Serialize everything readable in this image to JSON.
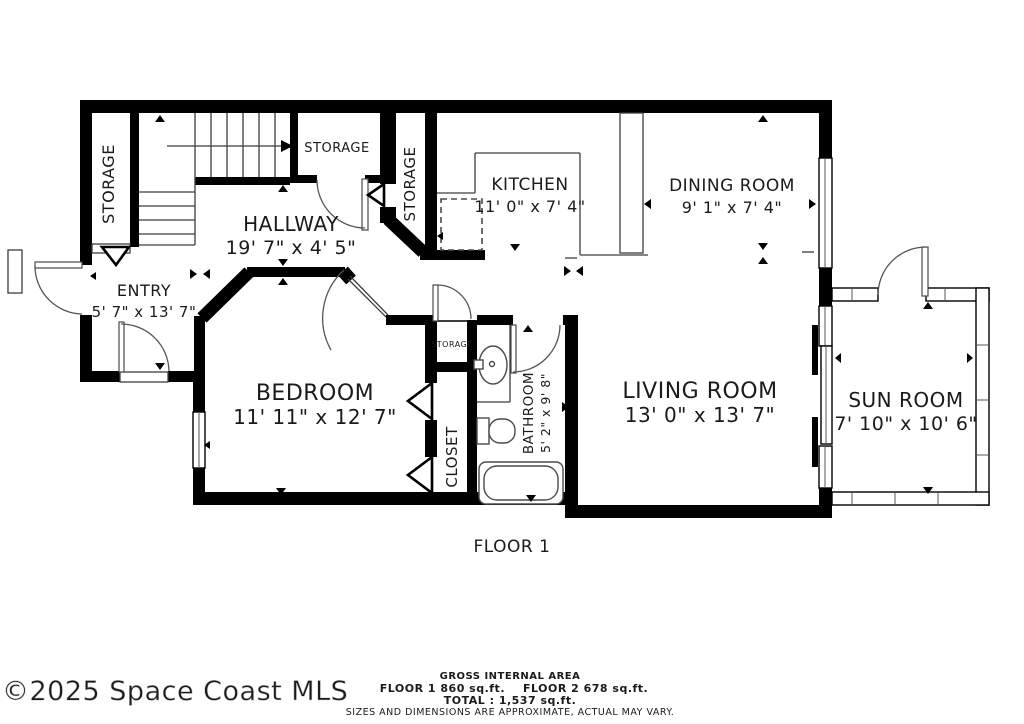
{
  "floor_label": "FLOOR 1",
  "watermark": "©2025 Space Coast MLS",
  "rooms": {
    "storage_left": {
      "name": "STORAGE"
    },
    "storage_mid": {
      "name": "STORAGE"
    },
    "storage_upper": {
      "name": "STORAGE"
    },
    "storage_small": {
      "name": "STORAGE"
    },
    "hallway": {
      "name": "HALLWAY",
      "dims": "19' 7\" x 4' 5\""
    },
    "kitchen": {
      "name": "KITCHEN",
      "dims": "11' 0\" x 7' 4\""
    },
    "dining": {
      "name": "DINING ROOM",
      "dims": "9' 1\" x 7' 4\""
    },
    "entry": {
      "name": "ENTRY",
      "dims": "5' 7\" x 13' 7\""
    },
    "bedroom": {
      "name": "BEDROOM",
      "dims": "11' 11\" x 12' 7\""
    },
    "closet": {
      "name": "CLOSET"
    },
    "bathroom": {
      "name": "BATHROOM",
      "dims": "5' 2\" x 9' 8\""
    },
    "living": {
      "name": "LIVING ROOM",
      "dims": "13' 0\" x 13' 7\""
    },
    "sunroom": {
      "name": "SUN ROOM",
      "dims": "7' 10\" x 10' 6\""
    }
  },
  "footer": {
    "gross_label": "GROSS INTERNAL AREA",
    "floor1_area": "FLOOR 1 860 sq.ft.",
    "floor2_area": "FLOOR 2 678 sq.ft.",
    "total": "TOTAL :  1,537 sq.ft.",
    "disclaimer": "SIZES AND DIMENSIONS ARE APPROXIMATE, ACTUAL MAY VARY."
  },
  "colors": {
    "wall": "#000000",
    "thin_line": "#3d3d3d",
    "text": "#1a1a1a",
    "watermark": "#d9d9d9",
    "disclaimer": "#555555"
  }
}
